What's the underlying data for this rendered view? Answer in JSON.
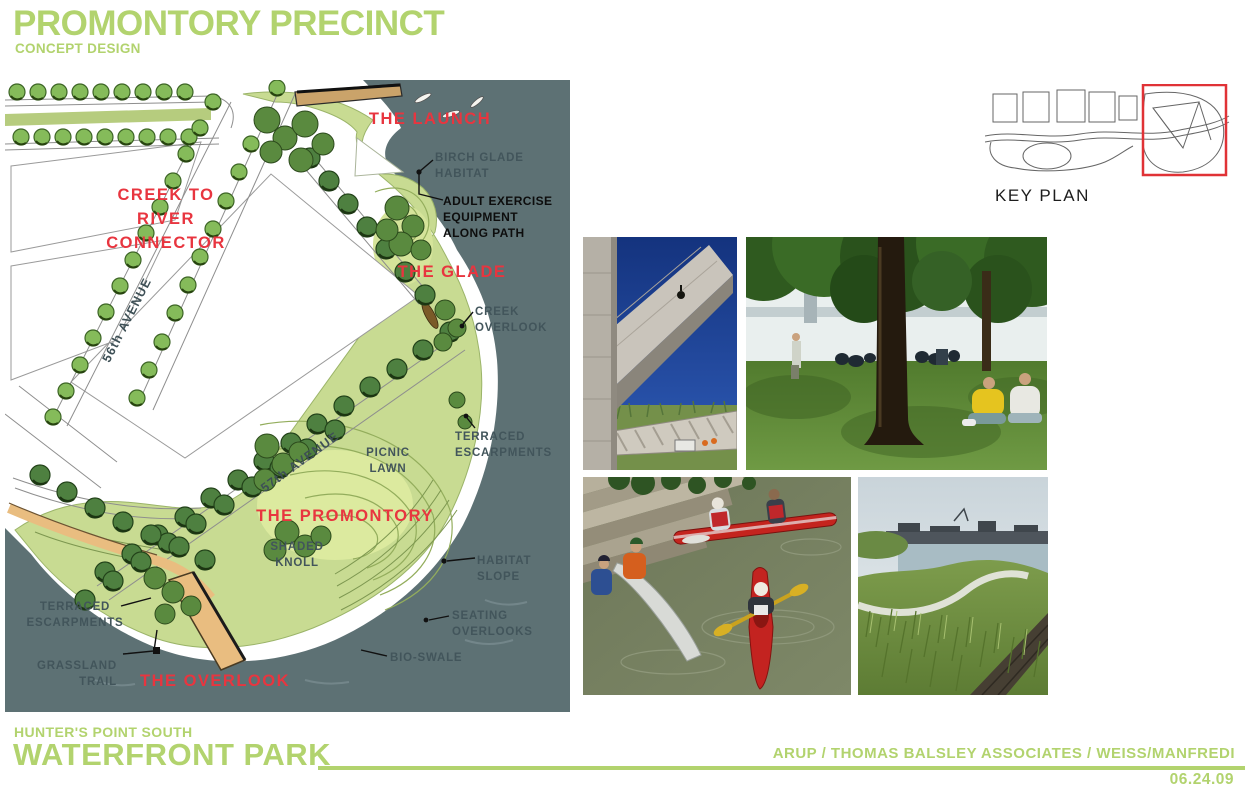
{
  "header": {
    "title": "PROMONTORY PRECINCT",
    "subtitle": "CONCEPT DESIGN"
  },
  "plan": {
    "labels": {
      "launch": "THE LAUNCH",
      "birch_glade": "BIRCH GLADE\nHABITAT",
      "adult_exercise": "ADULT EXERCISE\nEQUIPMENT\nALONG PATH",
      "glade": "THE GLADE",
      "creek_overlook": "CREEK\nOVERLOOK",
      "creek_connector": "CREEK TO\nRIVER\nCONNECTOR",
      "avenue_56": "56th AVENUE",
      "avenue_57": "57th AVENUE",
      "terraced_escarpments_right": "TERRACED\nESCARPMENTS",
      "picnic_lawn": "PICNIC\nLAWN",
      "promontory": "THE PROMONTORY",
      "shaded_knoll": "SHADED\nKNOLL",
      "habitat_slope": "HABITAT\nSLOPE",
      "seating_overlooks": "SEATING\nOVERLOOKS",
      "bio_swale": "BIO-SWALE",
      "terraced_escarpments_left": "TERRACED\nESCARPMENTS",
      "grassland_trail": "GRASSLAND\nTRAIL",
      "overlook": "THE OVERLOOK"
    }
  },
  "key_plan": {
    "caption": "KEY PLAN"
  },
  "footer": {
    "project_area": "HUNTER'S POINT SOUTH",
    "project_name": "WATERFRONT PARK",
    "consultants": "ARUP / THOMAS BALSLEY ASSOCIATES / WEISS/MANFREDI",
    "date": "06.24.09"
  },
  "colors": {
    "brand_green": "#b2d36e",
    "label_red": "#e8353f",
    "label_gray": "#42555b",
    "water_gray": "#5d7174",
    "park_green": "#c8db92",
    "promenade_orange": "#e9bd80"
  }
}
